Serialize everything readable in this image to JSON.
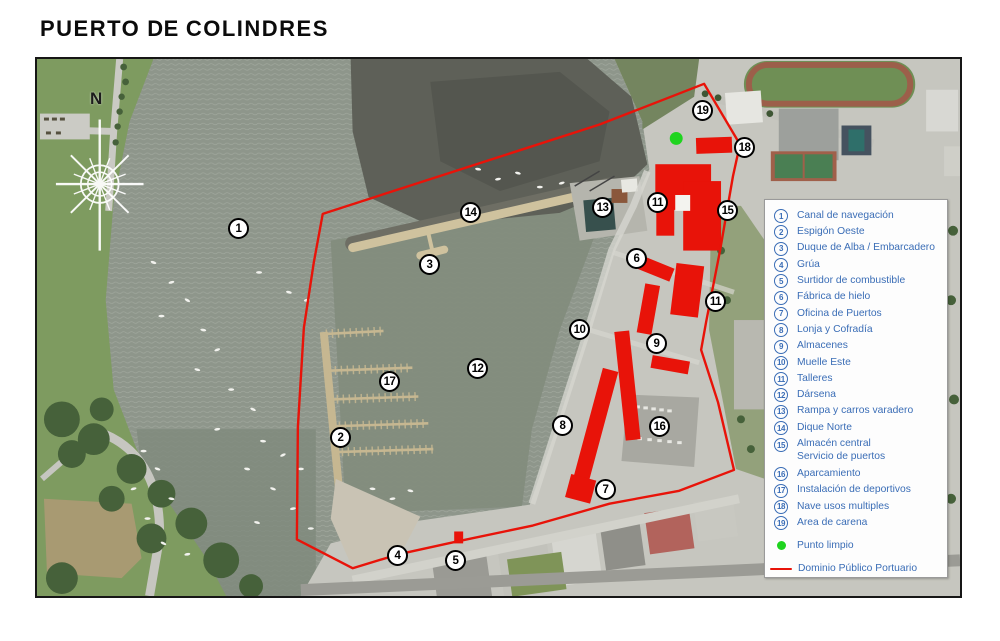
{
  "title": {
    "part1": "PUERTO",
    "part2": "DE",
    "part3": "COLINDRES"
  },
  "compass": {
    "north_label": "N"
  },
  "colors": {
    "accent_red": "#e81309",
    "legend_blue": "#3a6db6",
    "punto_green": "#1fd41f"
  },
  "map": {
    "markers": [
      {
        "n": "1",
        "x": 239,
        "y": 229
      },
      {
        "n": "2",
        "x": 341,
        "y": 438
      },
      {
        "n": "3",
        "x": 430,
        "y": 265
      },
      {
        "n": "4",
        "x": 398,
        "y": 556
      },
      {
        "n": "5",
        "x": 456,
        "y": 561
      },
      {
        "n": "6",
        "x": 637,
        "y": 259
      },
      {
        "n": "7",
        "x": 606,
        "y": 490
      },
      {
        "n": "8",
        "x": 563,
        "y": 426
      },
      {
        "n": "9",
        "x": 657,
        "y": 344
      },
      {
        "n": "10",
        "x": 580,
        "y": 330
      },
      {
        "n": "11",
        "x": 658,
        "y": 203
      },
      {
        "n": "11",
        "x": 716,
        "y": 302
      },
      {
        "n": "12",
        "x": 478,
        "y": 369
      },
      {
        "n": "13",
        "x": 603,
        "y": 208
      },
      {
        "n": "14",
        "x": 471,
        "y": 213
      },
      {
        "n": "15",
        "x": 728,
        "y": 211
      },
      {
        "n": "16",
        "x": 660,
        "y": 427
      },
      {
        "n": "17",
        "x": 390,
        "y": 382
      },
      {
        "n": "18",
        "x": 745,
        "y": 148
      },
      {
        "n": "19",
        "x": 703,
        "y": 111
      }
    ]
  },
  "legend": {
    "items": [
      {
        "n": "1",
        "label": "Canal de navegación"
      },
      {
        "n": "2",
        "label": "Espigón Oeste"
      },
      {
        "n": "3",
        "label": "Duque de Alba / Embarcadero"
      },
      {
        "n": "4",
        "label": "Grúa"
      },
      {
        "n": "5",
        "label": "Surtidor de combustible"
      },
      {
        "n": "6",
        "label": "Fábrica de hielo"
      },
      {
        "n": "7",
        "label": "Oficina de Puertos"
      },
      {
        "n": "8",
        "label": "Lonja y Cofradía"
      },
      {
        "n": "9",
        "label": "Almacenes"
      },
      {
        "n": "10",
        "label": "Muelle Este"
      },
      {
        "n": "11",
        "label": "Talleres"
      },
      {
        "n": "12",
        "label": "Dársena"
      },
      {
        "n": "13",
        "label": "Rampa y carros varadero"
      },
      {
        "n": "14",
        "label": "Dique Norte"
      },
      {
        "n": "15",
        "label": "Almacén central",
        "label2": "Servicio de puertos"
      },
      {
        "n": "16",
        "label": "Aparcamiento"
      },
      {
        "n": "17",
        "label": "Instalación de deportivos"
      },
      {
        "n": "18",
        "label": "Nave usos multiples"
      },
      {
        "n": "19",
        "label": "Area de carena"
      }
    ],
    "punto_limpio": {
      "label": "Punto limpio"
    },
    "dominio": {
      "label": "Dominio Público Portuario"
    }
  }
}
